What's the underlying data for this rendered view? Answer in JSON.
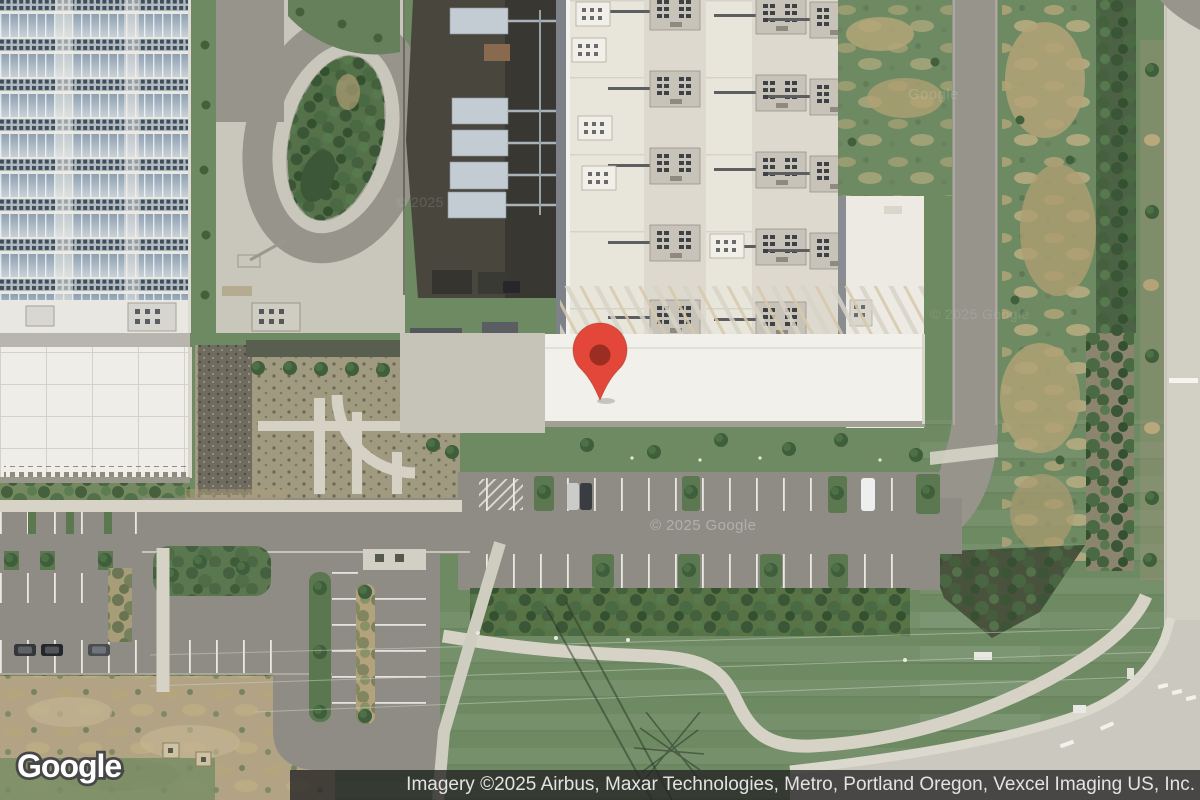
{
  "map": {
    "view_type": "satellite",
    "marker": {
      "name": "location-pin",
      "tip_x": 600,
      "tip_y": 400
    },
    "watermarks": [
      {
        "text": "© 2025 Google",
        "x": 650,
        "y": 517,
        "size": 15,
        "opacity": 0.3
      },
      {
        "text": "Google",
        "x": 908,
        "y": 86,
        "size": 15,
        "opacity": 0.14
      },
      {
        "text": "© 2025",
        "x": 396,
        "y": 194,
        "size": 14,
        "opacity": 0.13
      },
      {
        "text": "© 2025 Google",
        "x": 930,
        "y": 306,
        "size": 14,
        "opacity": 0.11
      }
    ]
  },
  "footer": {
    "logo_text": "Google",
    "attribution_text": "Imagery ©2025 Airbus, Maxar Technologies, Metro, Portland Oregon, Vexcel Imaging US, Inc."
  },
  "colors": {
    "lawn": "#6e8a63",
    "asphalt": "#8f8c85",
    "road": "#97948c",
    "concrete": "#c9c6bc",
    "sidewalk": "#d7d3c7",
    "roof-white": "#f2f0ea",
    "roof-main": "#e8e5db",
    "roof-solar": "#e9e7e2",
    "yard": "#49463d",
    "hedge": "#587446",
    "brush": "#b3a377",
    "field": "#b1a384",
    "pin-outer": "#e2473a",
    "pin-inner": "#9c2d22",
    "attr-bg": "rgba(35,35,35,0.78)",
    "attr-text": "#e3e3e3",
    "wm": "#ffffff"
  }
}
